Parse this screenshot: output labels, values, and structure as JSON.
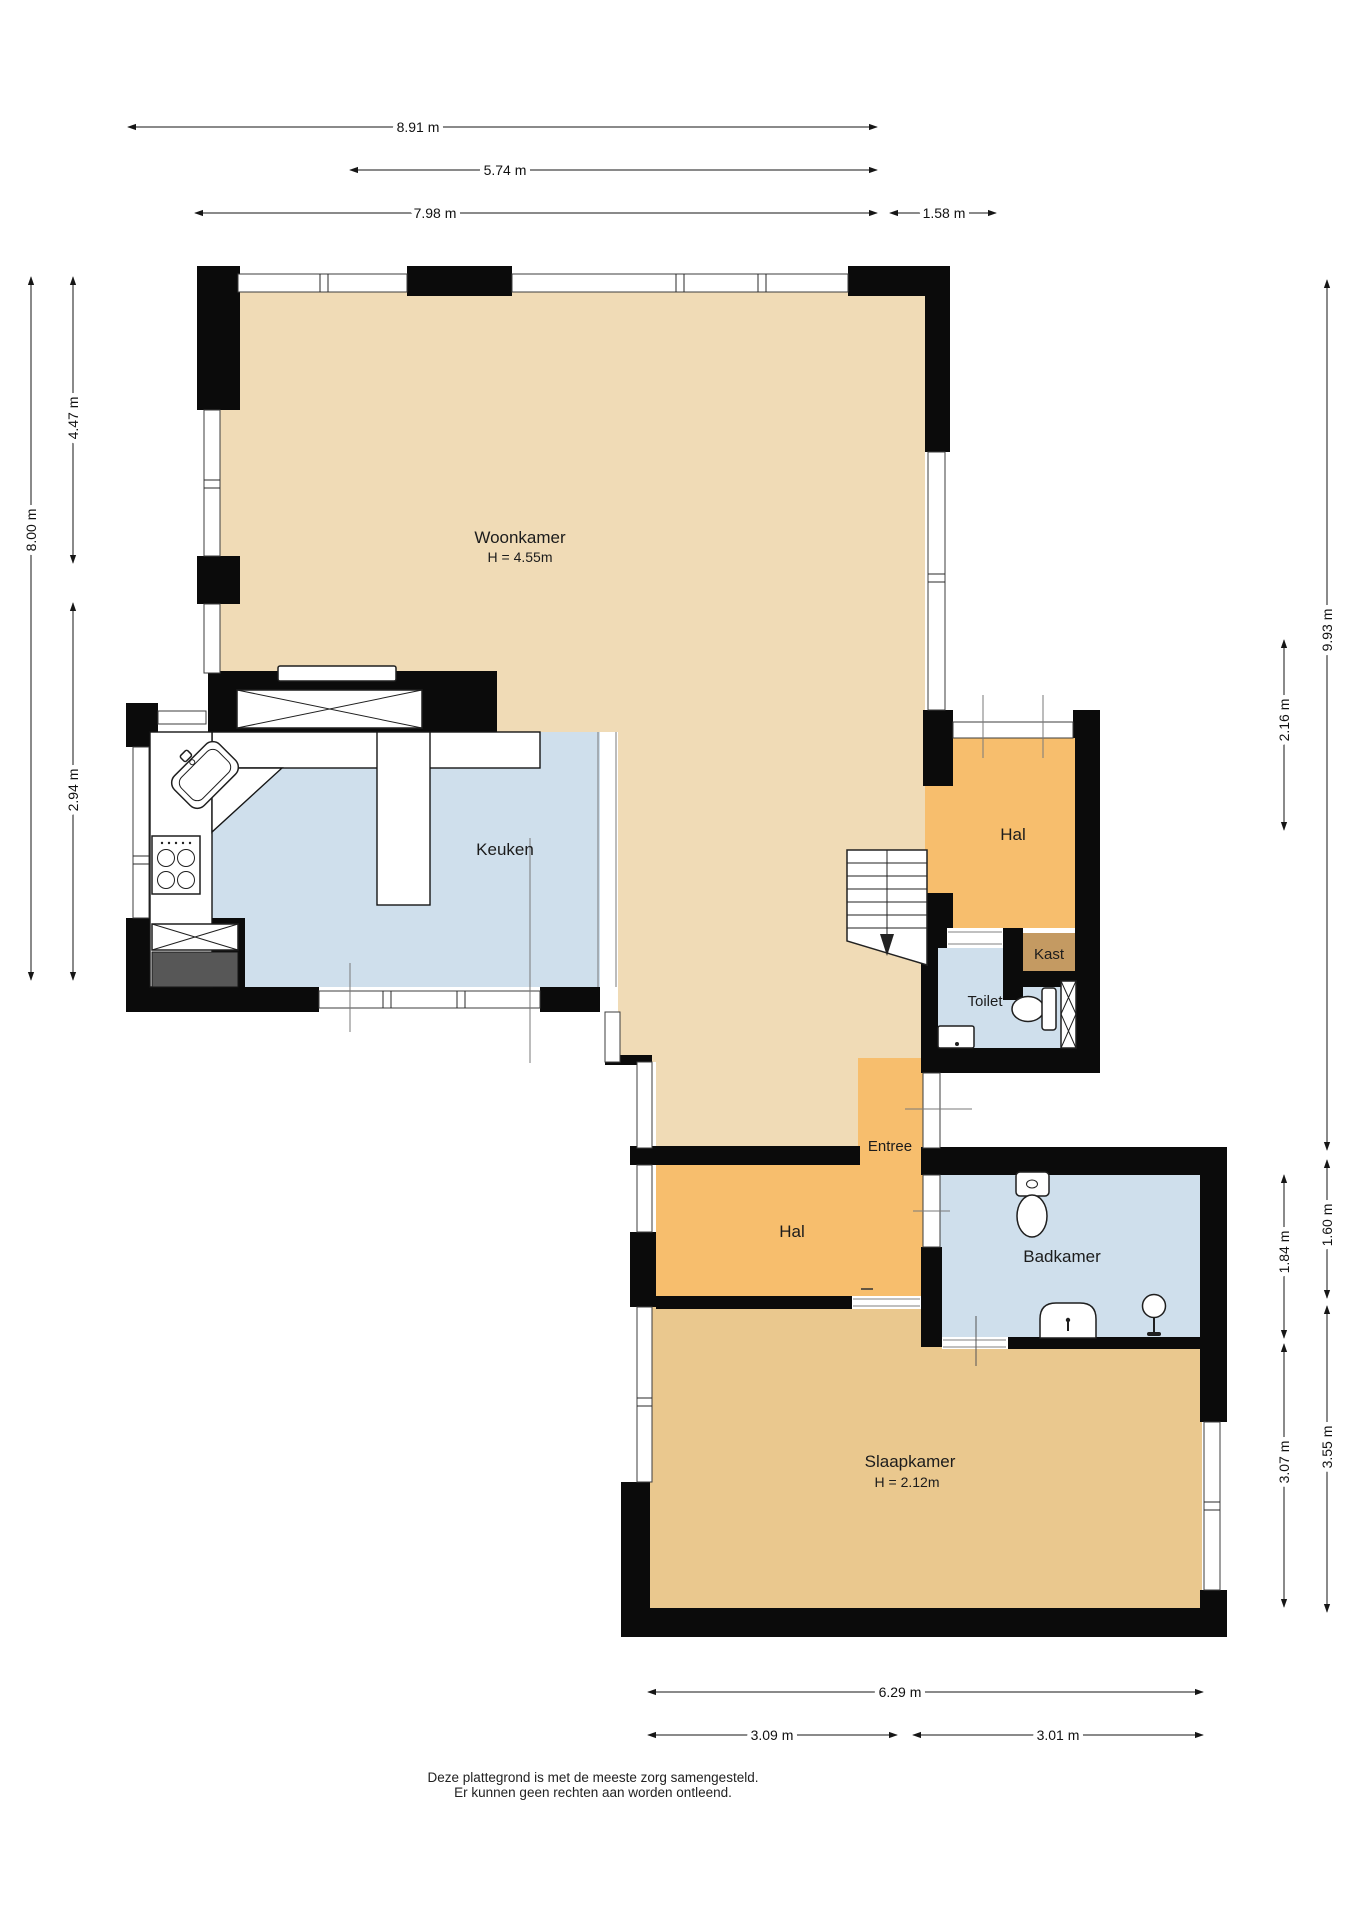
{
  "rooms": {
    "woonkamer": {
      "label": "Woonkamer",
      "sublabel": "H = 4.55m",
      "floor_color": "#f0dbb6"
    },
    "keuken": {
      "label": "Keuken",
      "floor_color": "#cfdfec"
    },
    "hal_boven": {
      "label": "Hal",
      "floor_color": "#f7be6d"
    },
    "kast": {
      "label": "Kast",
      "floor_color": "#c49a62"
    },
    "toilet": {
      "label": "Toilet",
      "floor_color": "#cfdfec"
    },
    "entree": {
      "label": "Entree",
      "floor_color": "#f7be6d"
    },
    "hal_beneden": {
      "label": "Hal",
      "floor_color": "#f7be6d"
    },
    "badkamer": {
      "label": "Badkamer",
      "floor_color": "#cfdfec"
    },
    "slaapkamer": {
      "label": "Slaapkamer",
      "sublabel": "H = 2.12m",
      "floor_color": "#eac88e"
    }
  },
  "dimensions": {
    "top": [
      "8.91 m",
      "5.74 m",
      "7.98 m",
      "1.58 m"
    ],
    "left": [
      "8.00 m",
      "4.47 m",
      "2.94 m"
    ],
    "right": [
      "9.93 m",
      "2.16 m",
      "1.60 m",
      "1.84 m",
      "3.55 m",
      "3.07 m"
    ],
    "bottom": [
      "6.29 m",
      "3.09 m",
      "3.01 m"
    ]
  },
  "footer": {
    "line1": "Deze plattegrond is met de meeste zorg samengesteld.",
    "line2": "Er kunnen geen rechten aan worden ontleend."
  },
  "palette": {
    "wall": "#0b0b0b",
    "window_line": "#3d3d3d",
    "dimension_line": "#161616",
    "appliance_dark": "#575757"
  }
}
